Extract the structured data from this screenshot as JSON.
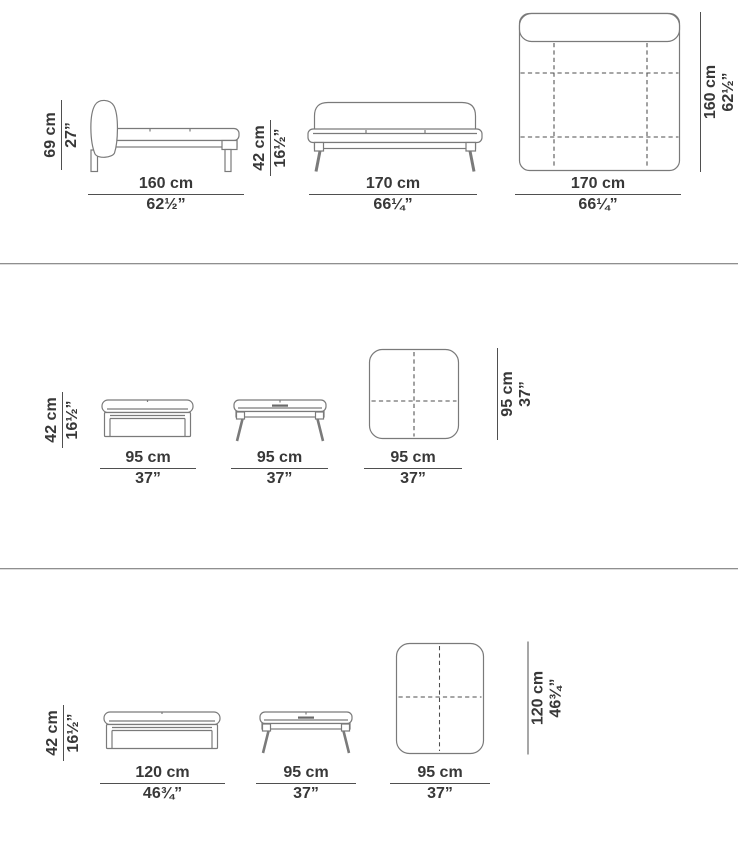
{
  "colors": {
    "background": "#ffffff",
    "text": "#383838",
    "drawing_line": "#7a7a7a",
    "dimension_line": "#4f4f4f",
    "separator": "#8f8f8f"
  },
  "rows": [
    {
      "figures": {
        "side": {
          "height_cm": "69 cm",
          "height_in": "27”",
          "width_cm": "160 cm",
          "width_in": "62½”"
        },
        "front": {
          "height_cm": "42 cm",
          "height_in": "16½”",
          "width_cm": "170 cm",
          "width_in": "66¼”"
        },
        "top": {
          "depth_cm": "160 cm",
          "depth_in": "62½”",
          "width_cm": "170 cm",
          "width_in": "66¼”"
        }
      }
    },
    {
      "figures": {
        "side": {
          "height_cm": "42 cm",
          "height_in": "16½”",
          "width_cm": "95 cm",
          "width_in": "37”"
        },
        "front": {
          "width_cm": "95 cm",
          "width_in": "37”"
        },
        "top": {
          "depth_cm": "95 cm",
          "depth_in": "37”",
          "width_cm": "95 cm",
          "width_in": "37”"
        }
      }
    },
    {
      "figures": {
        "side": {
          "height_cm": "42 cm",
          "height_in": "16½”",
          "width_cm": "120 cm",
          "width_in": "46¾”"
        },
        "front": {
          "width_cm": "95 cm",
          "width_in": "37”"
        },
        "top": {
          "depth_cm": "120 cm",
          "depth_in": "46¾”",
          "width_cm": "95 cm",
          "width_in": "37”"
        }
      }
    }
  ]
}
